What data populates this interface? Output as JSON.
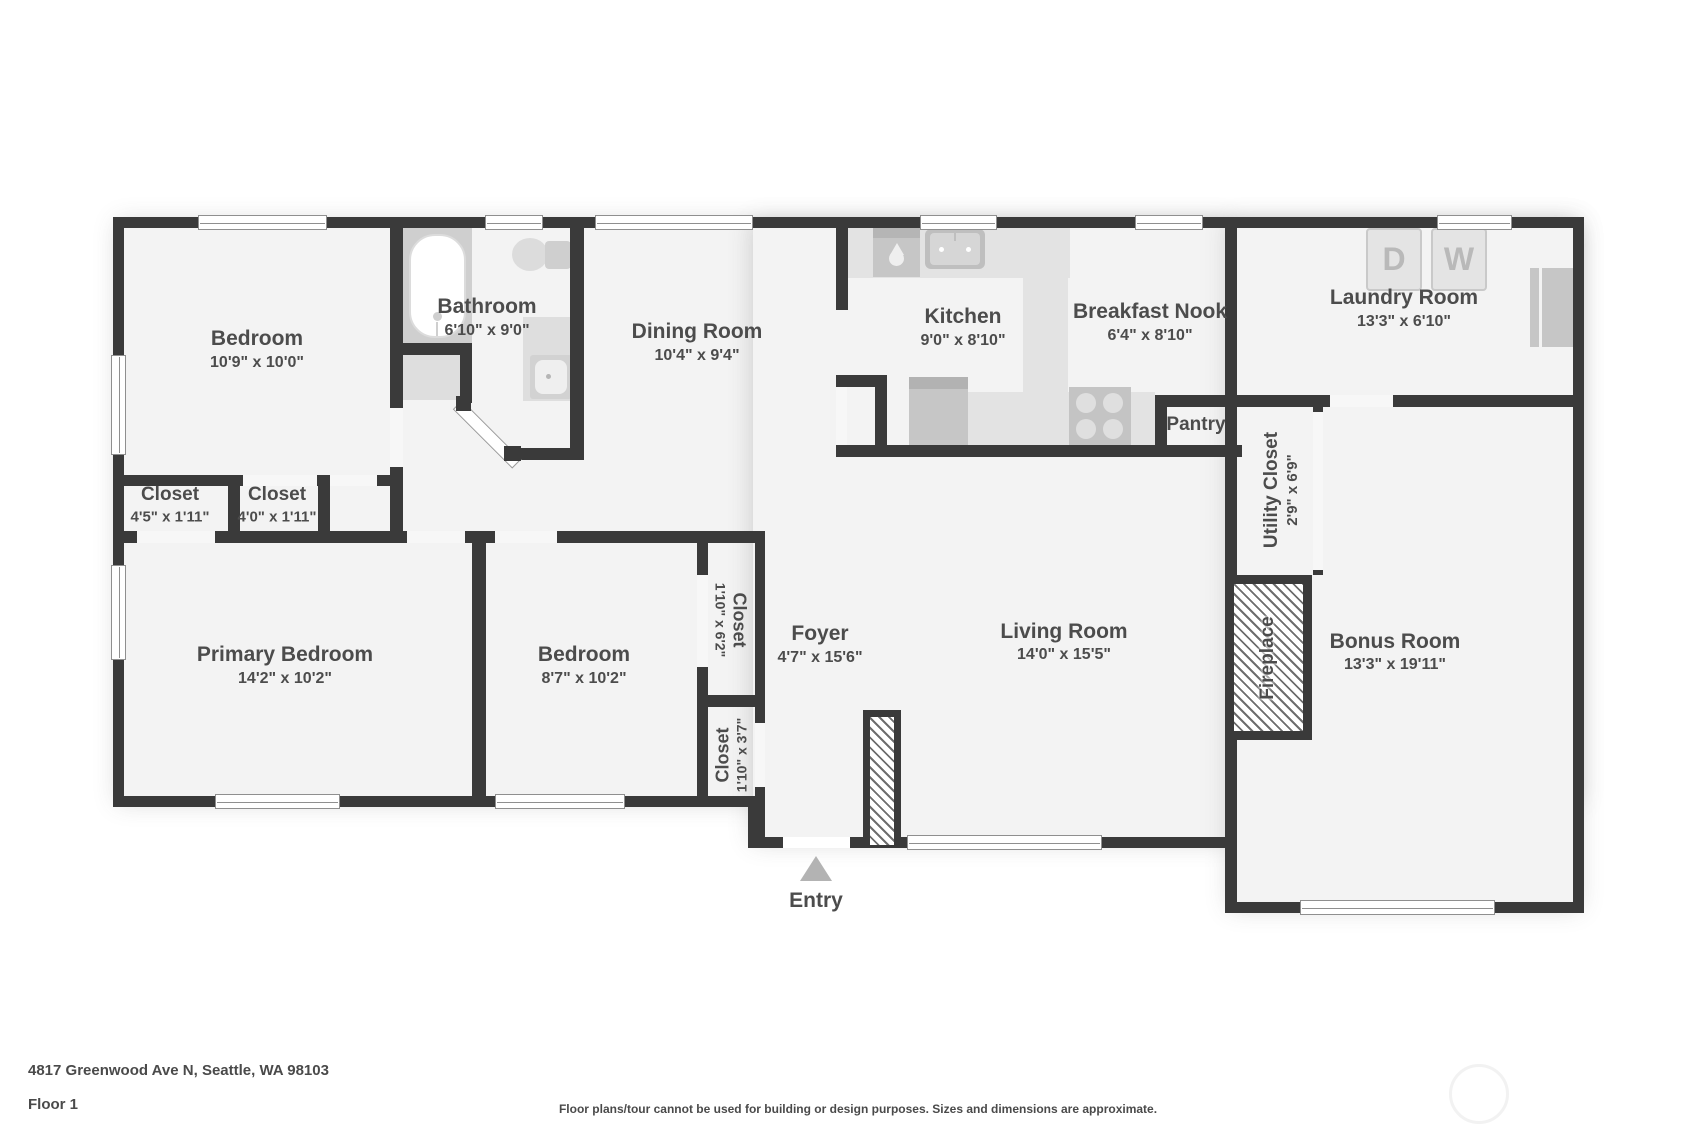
{
  "fp": {
    "rooms": {
      "bedroom1": {
        "name": "Bedroom",
        "dims": "10'9\" x 10'0\""
      },
      "bathroom": {
        "name": "Bathroom",
        "dims": "6'10\" x 9'0\""
      },
      "dining": {
        "name": "Dining Room",
        "dims": "10'4\" x 9'4\""
      },
      "kitchen": {
        "name": "Kitchen",
        "dims": "9'0\" x 8'10\""
      },
      "nook": {
        "name": "Breakfast Nook",
        "dims": "6'4\" x 8'10\""
      },
      "laundry": {
        "name": "Laundry Room",
        "dims": "13'3\" x 6'10\""
      },
      "pantry": {
        "name": "Pantry"
      },
      "utility": {
        "name": "Utility Closet",
        "dims": "2'9\" x 6'9\""
      },
      "closet_hall_1": {
        "name": "Closet",
        "dims": "4'5\" x 1'11\""
      },
      "closet_hall_2": {
        "name": "Closet",
        "dims": "4'0\" x 1'11\""
      },
      "primary": {
        "name": "Primary Bedroom",
        "dims": "14'2\" x 10'2\""
      },
      "bedroom2": {
        "name": "Bedroom",
        "dims": "8'7\" x 10'2\""
      },
      "closet_foyer_1": {
        "name": "Closet",
        "dims": "1'10\" x 6'2\""
      },
      "closet_foyer_2": {
        "name": "Closet",
        "dims": "1'10\" x 3'7\""
      },
      "foyer": {
        "name": "Foyer",
        "dims": "4'7\" x 15'6\""
      },
      "living": {
        "name": "Living Room",
        "dims": "14'0\" x 15'5\""
      },
      "fireplace": {
        "name": "Fireplace"
      },
      "bonus": {
        "name": "Bonus Room",
        "dims": "13'3\" x 19'11\""
      }
    },
    "appliances": {
      "dryer": "D",
      "washer": "W"
    },
    "entry_label": "Entry"
  },
  "footer": {
    "address": "4817 Greenwood Ave N, Seattle, WA 98103",
    "floor": "Floor 1",
    "disclaimer": "Floor plans/tour cannot be used for building or design purposes. Sizes and dimensions are approximate."
  },
  "colors": {
    "wall": "#3a3a3a",
    "floor": "#f3f3f3",
    "label": "#4c4c4c"
  }
}
